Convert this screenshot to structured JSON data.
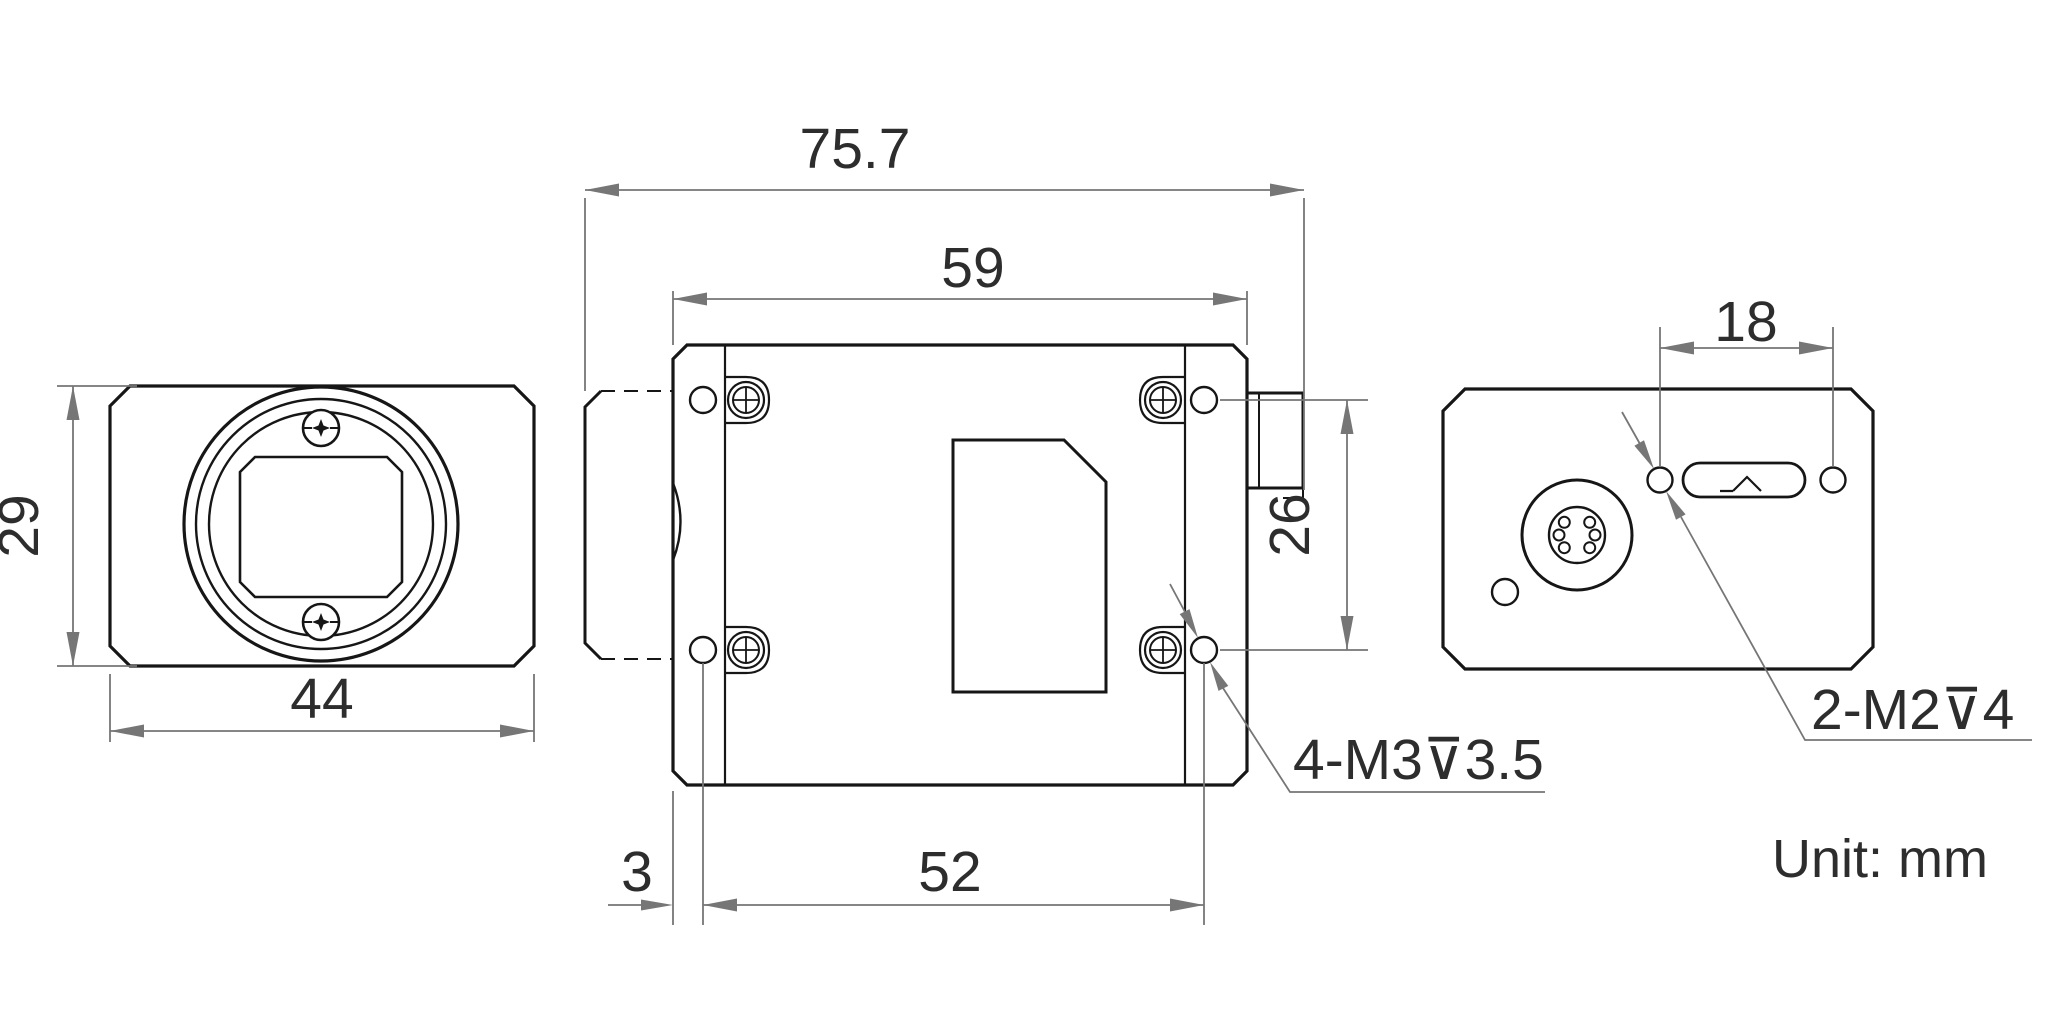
{
  "drawing": {
    "name": "industrial-camera-dimension-drawing",
    "unit_label": "Unit: mm",
    "dimensions": {
      "overall_length": "75.7",
      "body_length": "59",
      "front_height": "29",
      "front_width": "44",
      "side_hole_spacing_vertical": "26",
      "bottom_hole_offset": "3",
      "bottom_hole_spacing": "52",
      "back_hole_spacing": "18"
    },
    "thread_labels": {
      "side_mount_holes": "4-M3⊽3.5",
      "back_mount_holes": "2-M2⊽4"
    },
    "colors": {
      "background": "#ffffff",
      "outline": "#161616",
      "dimension_gray": "#767676",
      "text": "#2d2d2d"
    }
  }
}
